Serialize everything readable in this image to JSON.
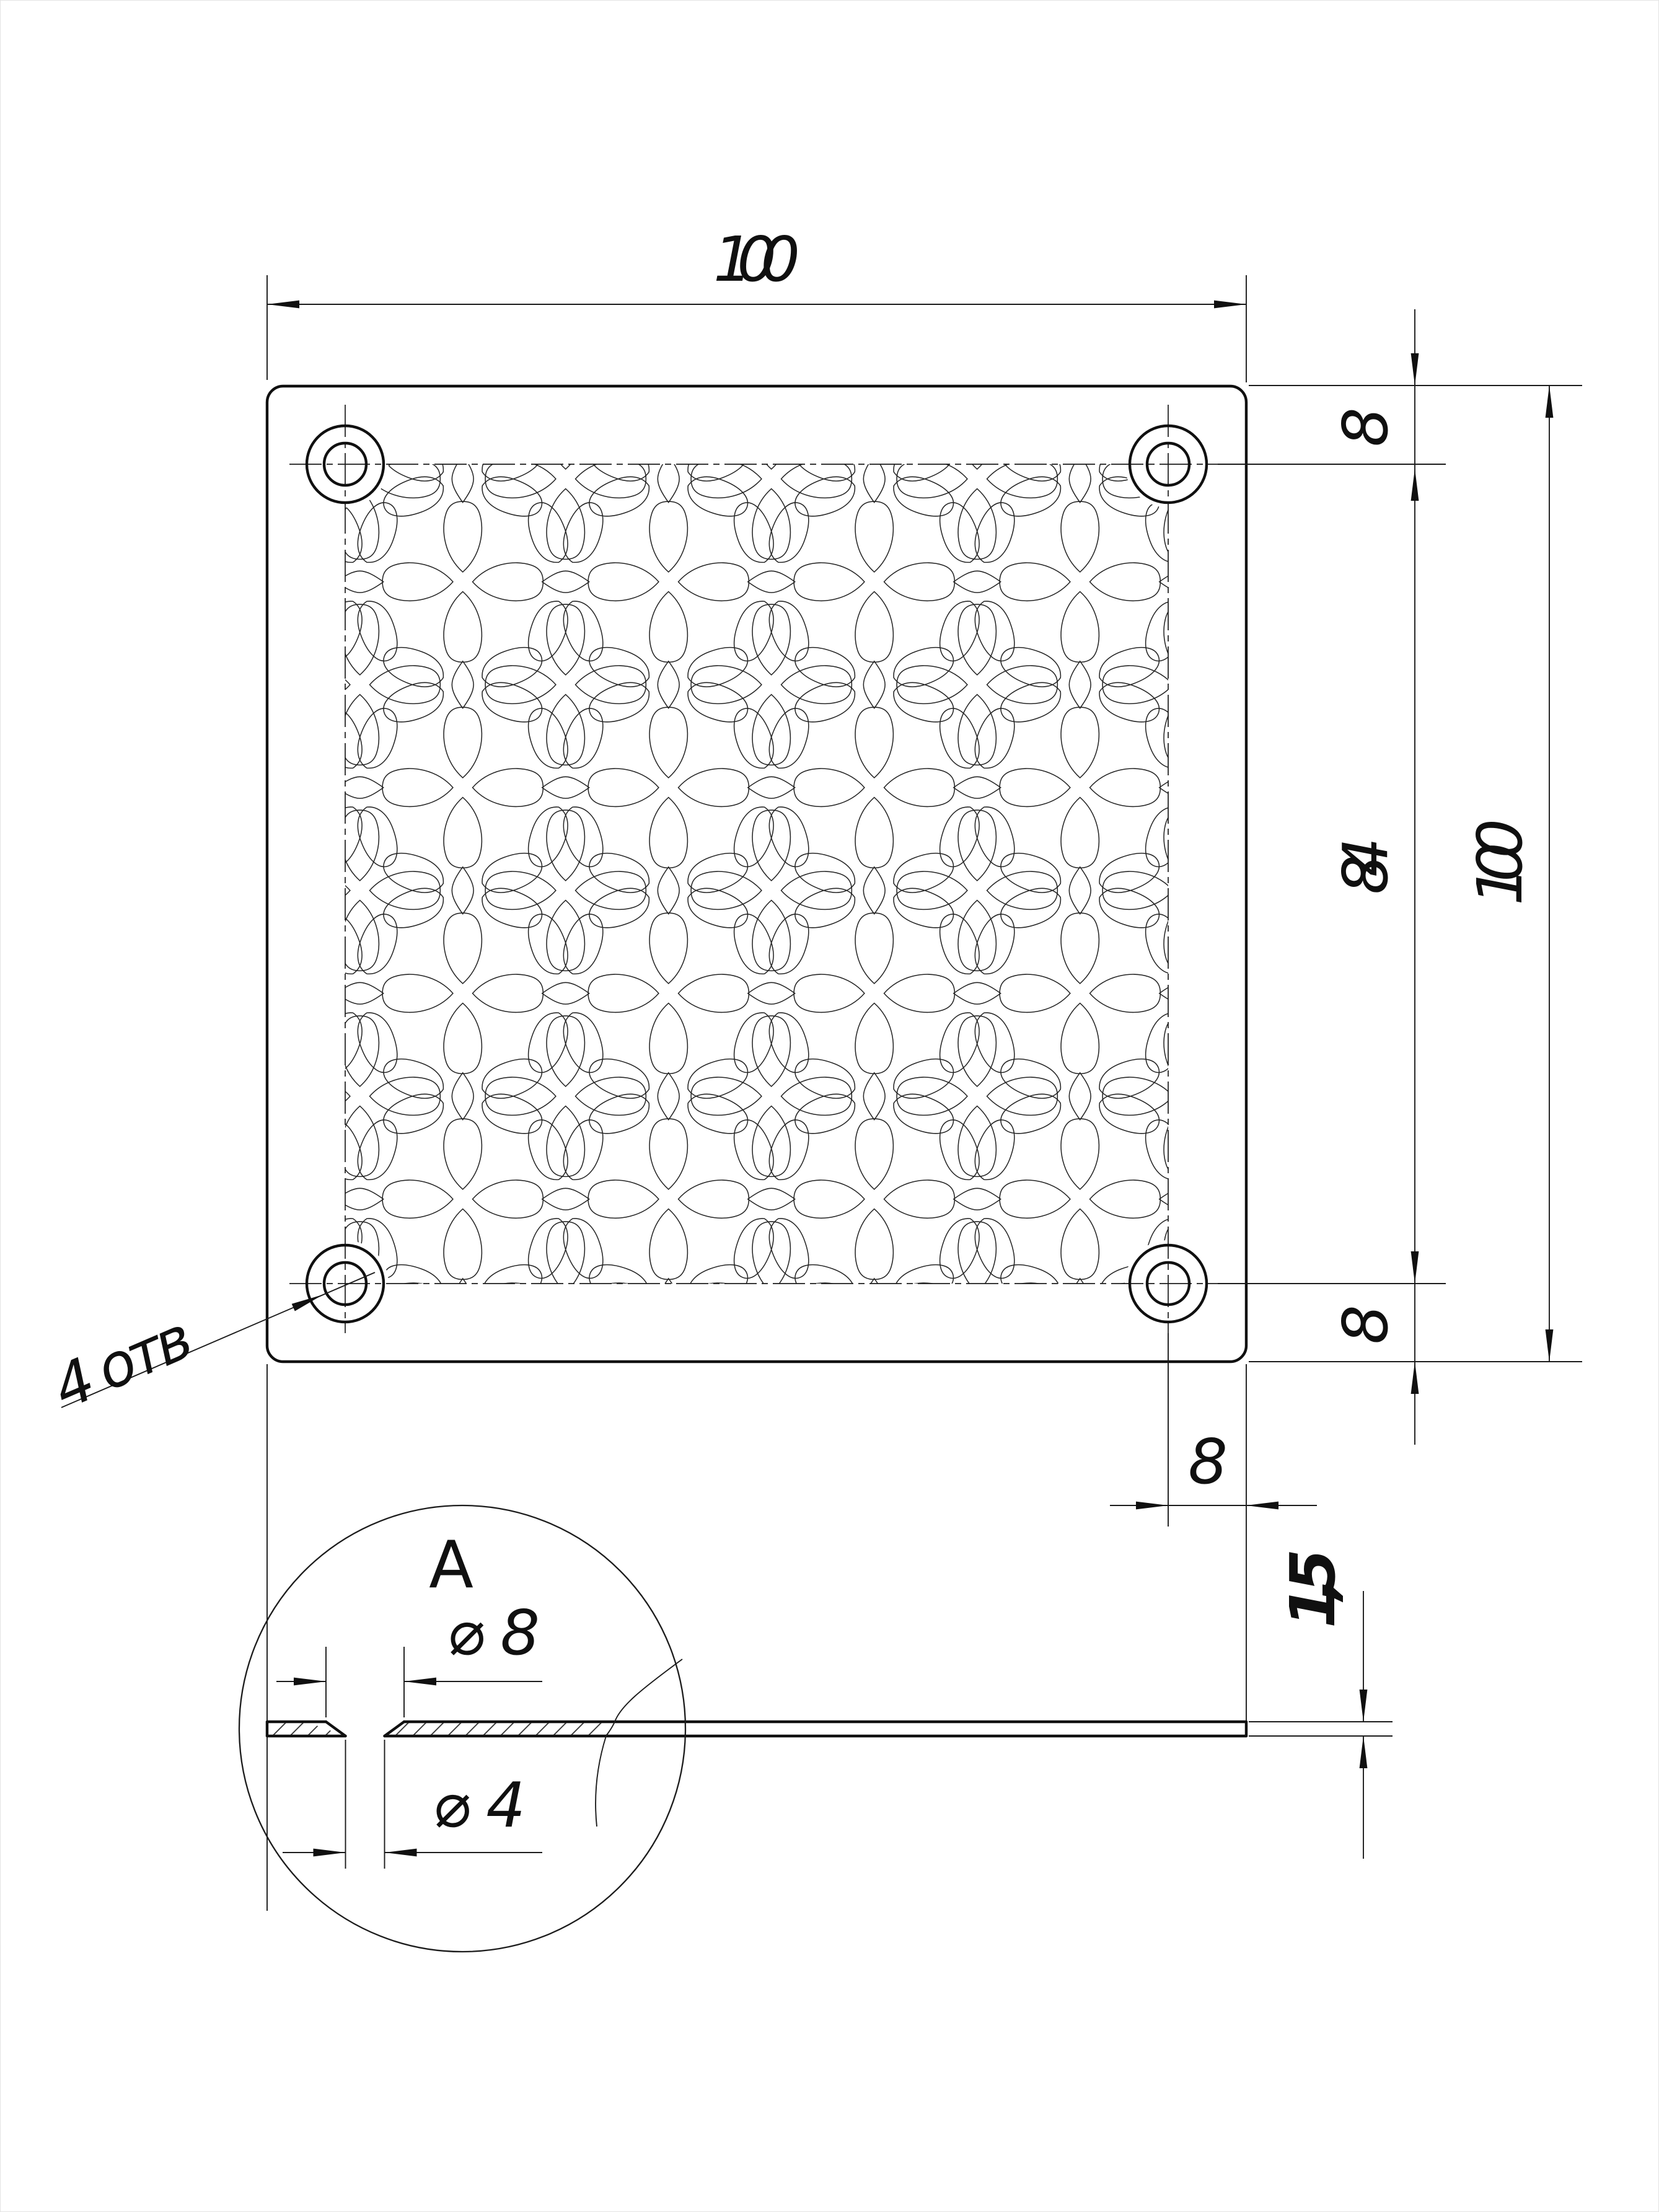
{
  "drawing": {
    "type": "engineering-drawing",
    "units": "mm",
    "top_view": {
      "dim_width_top": "100",
      "dim_hole_edge_top_right": "8",
      "dim_hole_pitch_right": "84",
      "dim_height_right": "100",
      "dim_hole_edge_bottom_right": "8",
      "dim_hole_edge_bottom": "8",
      "holes_note": "4 отв"
    },
    "side_view": {
      "dim_thickness": "1,5"
    },
    "detail_view": {
      "label": "А",
      "dim_countersink_diameter": "⌀ 8",
      "dim_hole_diameter": "⌀ 4"
    },
    "colors": {
      "ink": "#101010",
      "paper": "#ffffff"
    }
  }
}
